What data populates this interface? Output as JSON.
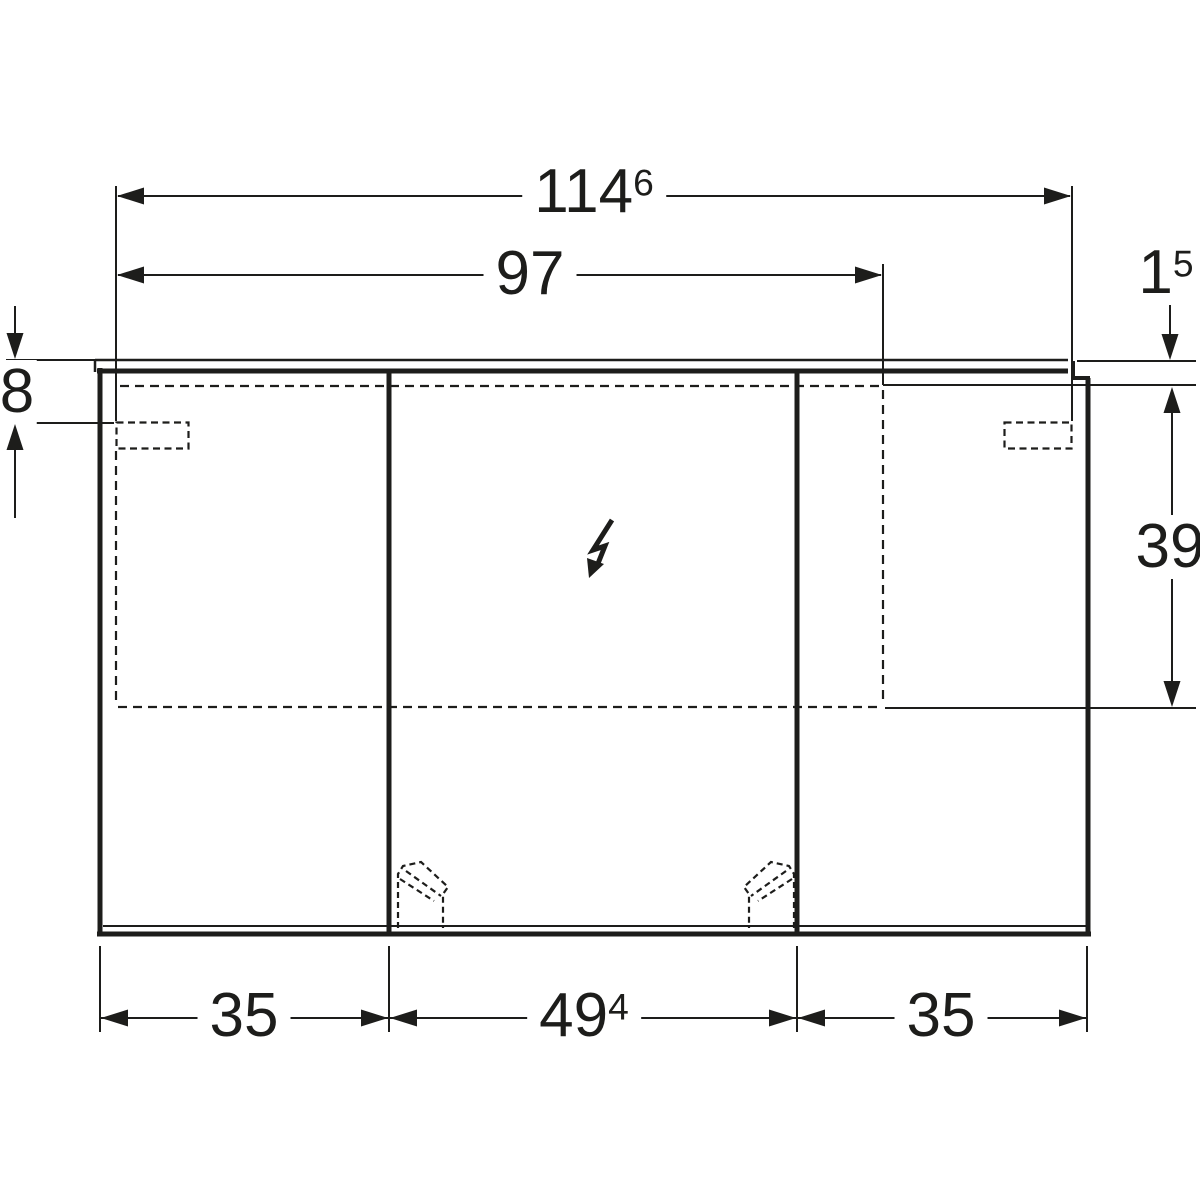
{
  "colors": {
    "ink": "#1d1d1b",
    "paper": "#ffffff"
  },
  "icons": {
    "electrical_symbol": "lightning-arrow"
  },
  "dimensions": {
    "total_width": {
      "main": "114",
      "sup": "6"
    },
    "upper_width": {
      "main": "97"
    },
    "top_profile": {
      "main": "1",
      "sup": "5"
    },
    "top_offset": {
      "main": "8"
    },
    "side_height": {
      "main": "39"
    },
    "door_left": {
      "main": "35"
    },
    "door_center": {
      "main": "49",
      "sup": "4"
    },
    "door_right": {
      "main": "35"
    }
  }
}
